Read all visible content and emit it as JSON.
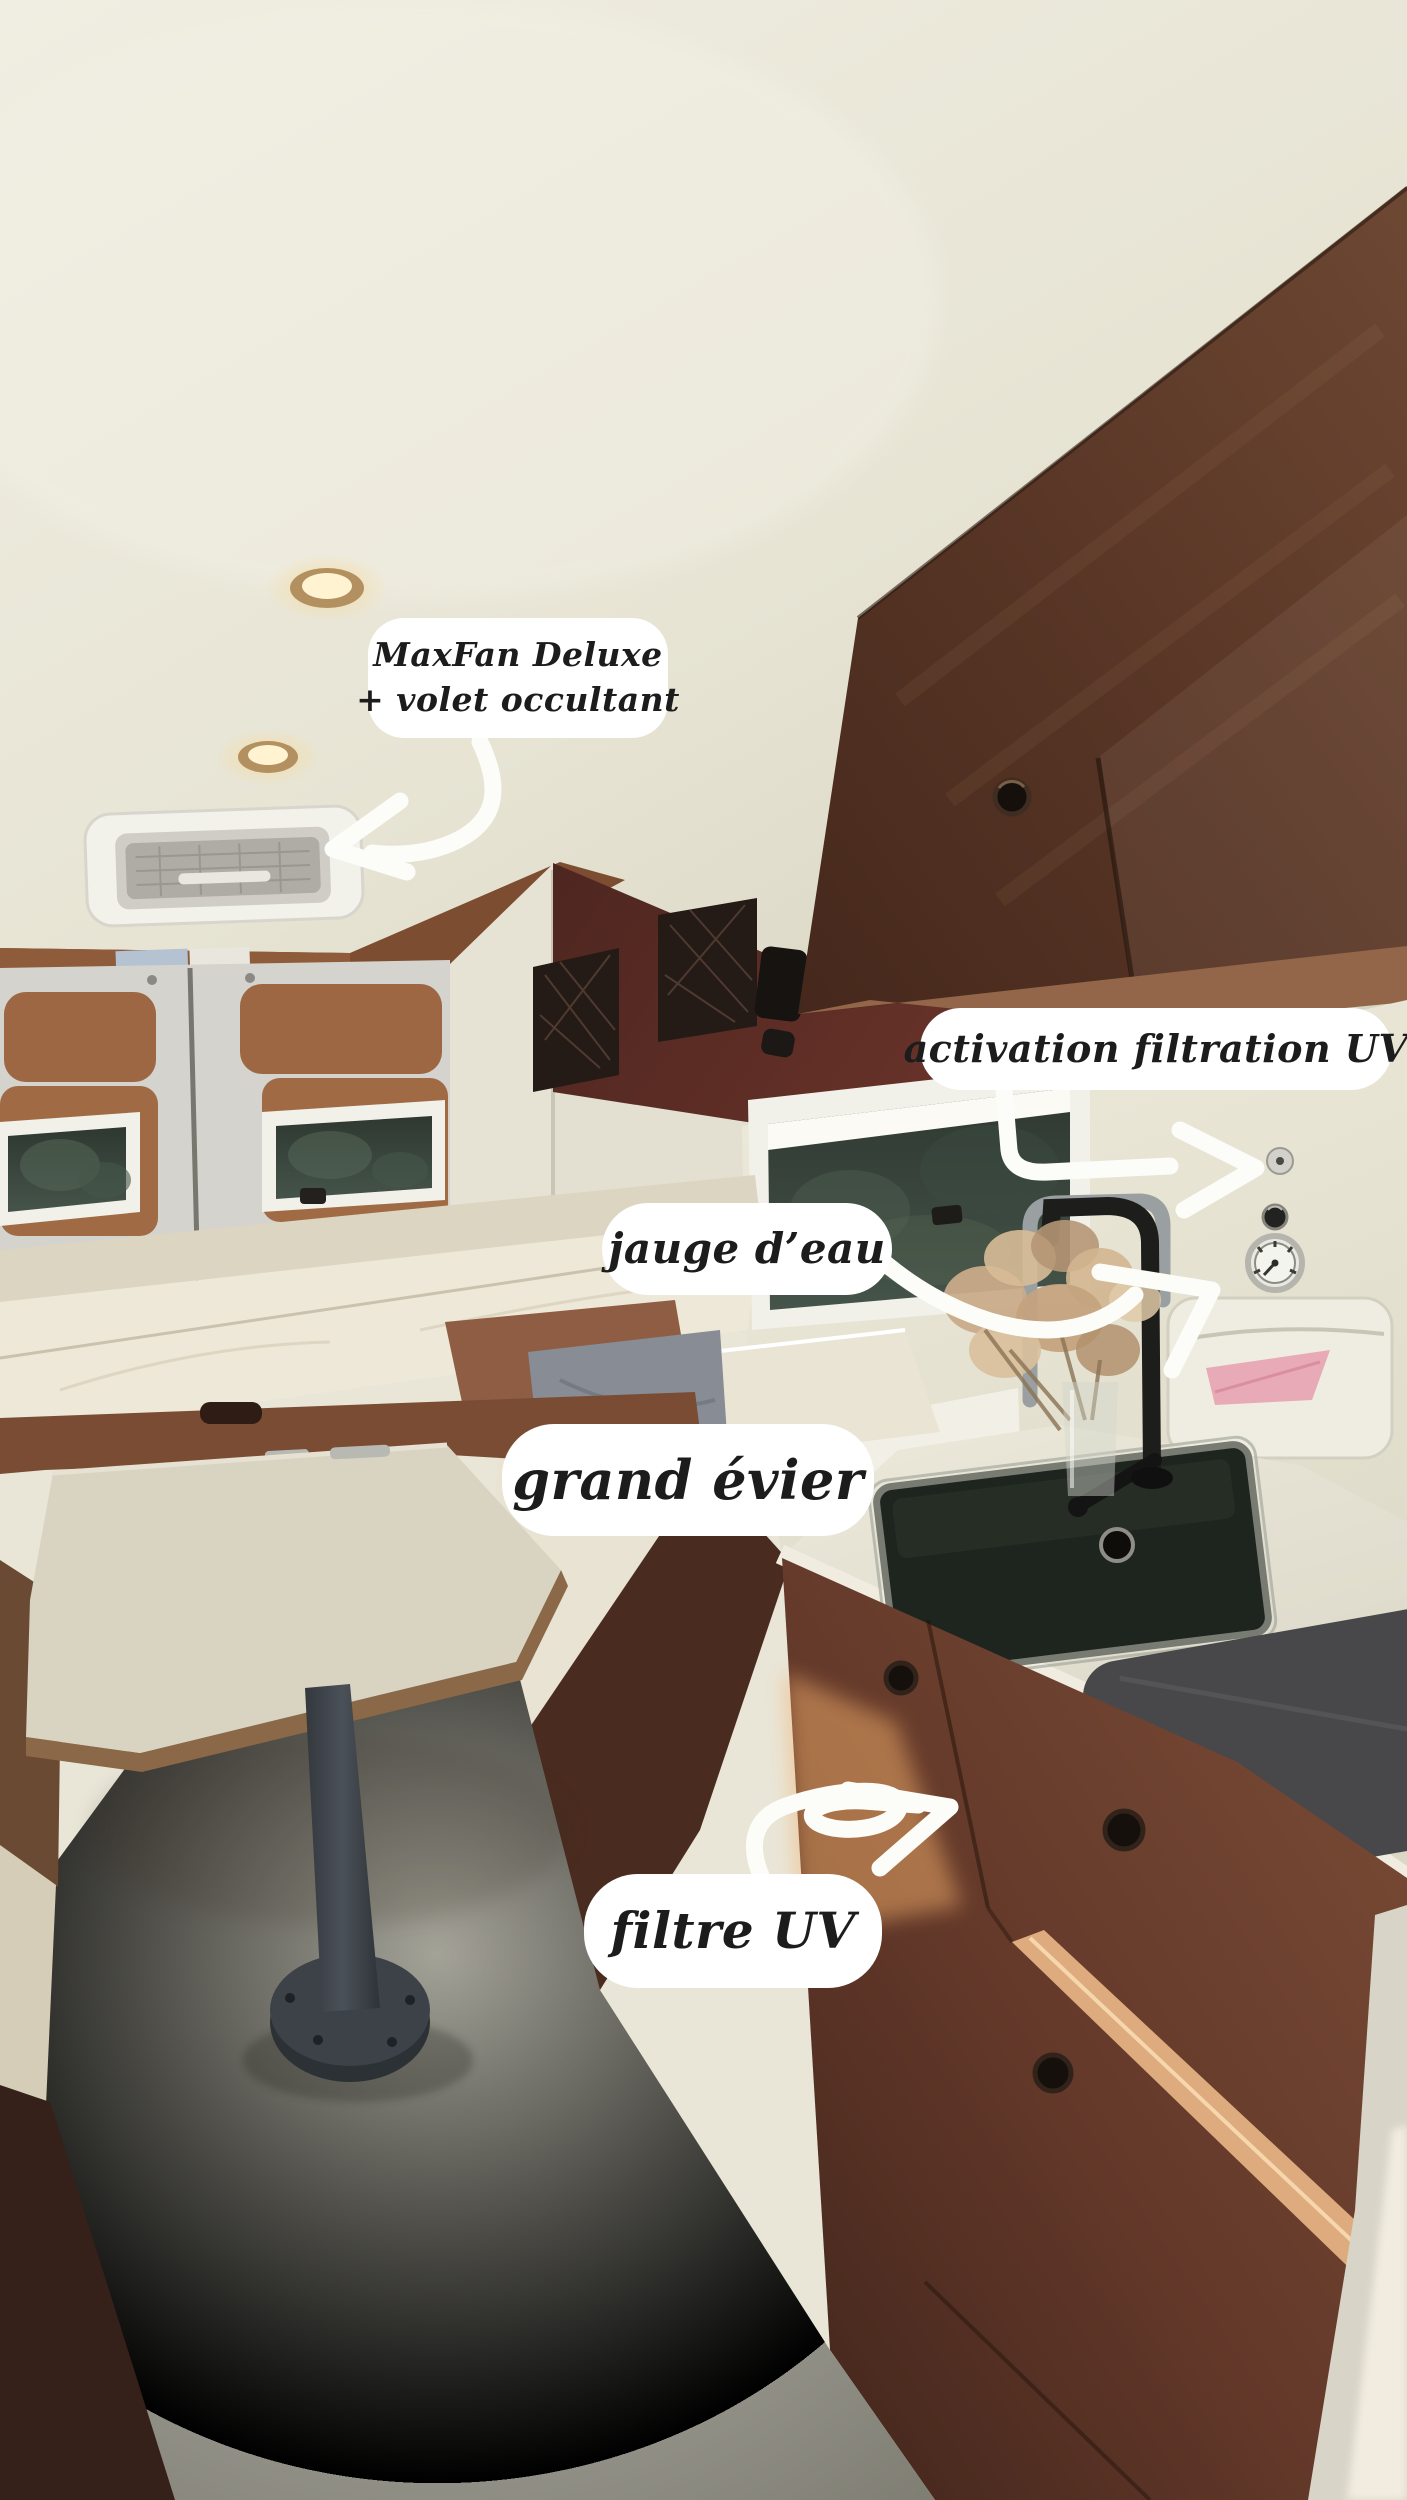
{
  "meta": {
    "kind": "annotated interior photo",
    "subject": "campervan conversion interior (dinette, bed, kitchen sink) with handwritten-style feature callouts",
    "width_px": 1407,
    "height_px": 2500
  },
  "annotations": {
    "maxfan": {
      "line1": "MaxFan Deluxe",
      "line2": "+ volet occultant"
    },
    "activation_filtration": {
      "text": "activation filtration UV"
    },
    "jauge_eau": {
      "text": "jauge d’eau"
    },
    "grand_evier": {
      "text": "grand évier"
    },
    "filtre_uv": {
      "text": "filtre UV"
    }
  },
  "colors": {
    "label_background": "#ffffff",
    "label_text": "#1c1c1c",
    "arrow_white": "#fcfcf9",
    "ceiling_cream": "#eceadd",
    "overhead_cabinet_wood": "#5a3727",
    "cabinet_underside": "#93664a",
    "wall_maroon": "#5f2f27",
    "door_grey": "#d4d3ce",
    "door_panel_wood": "#9c6742",
    "mattress_cream": "#ece6d6",
    "counter_cream": "#e7e3d5",
    "sink_dark": "#1e241e",
    "mat_grey": "#48484a",
    "lower_cabinet_wood": "#6e4330",
    "sunlight_streak": "#e8b27e",
    "floor_grey": "#95948a",
    "pink_cloth": "#e8aab6",
    "table_top": "#d9d3c2",
    "table_leg": "#3c4248"
  }
}
